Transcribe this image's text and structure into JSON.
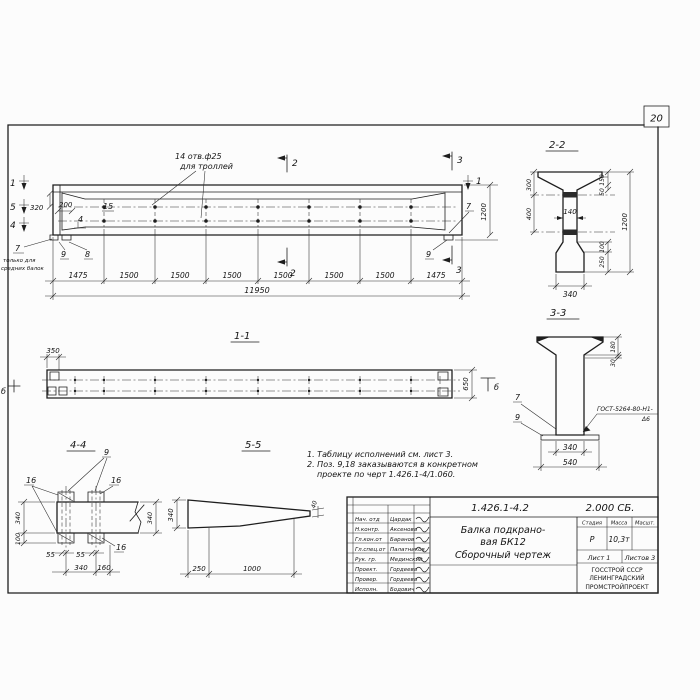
{
  "sheet": {
    "number": "20"
  },
  "main_view": {
    "holes_note1": "14 отв.ф25",
    "holes_note2": "для троллей",
    "mark_1_left": "1",
    "mark_5": "5",
    "mark_4": "4",
    "mark_2_top": "2",
    "mark_2_bottom": "2",
    "mark_3_top": "3",
    "mark_3_bottom": "3",
    "mark_1_right": "1",
    "dim_320": "320",
    "dim_200": "200",
    "pos_15": "15",
    "pos_4": "4",
    "pos_7": "7",
    "note_7a": "только для",
    "note_7b": "средних балок",
    "pos_9_left": "9",
    "pos_8": "8",
    "pos_9_right": "9",
    "pos_7_right": "7",
    "dim_1200": "1200",
    "segs": [
      "1475",
      "1500",
      "1500",
      "1500",
      "1500",
      "1500",
      "1500",
      "1475"
    ],
    "total": "11950"
  },
  "section_2_2": {
    "title": "2-2",
    "d300": "300",
    "d400": "400",
    "d150": "150",
    "d50": "50",
    "d1200": "1200",
    "d100": "100",
    "d250": "250",
    "d140": "140",
    "d340": "340"
  },
  "section_3_3": {
    "title": "3-3",
    "d180": "180",
    "d30": "30",
    "d340": "340",
    "d540": "540",
    "pos7": "7",
    "pos9": "9",
    "weld1": "ГОСТ-5264-80-Н1-",
    "weld2": "Δ6"
  },
  "section_1_1": {
    "title": "1-1",
    "d350": "350",
    "d650": "650",
    "mark_left": "б",
    "mark_right": "б"
  },
  "section_4_4": {
    "title": "4-4",
    "pos9": "9",
    "pos16_left": "16",
    "pos16_right": "16",
    "pos16_bottom": "16",
    "d340_left": "340",
    "d100": "100",
    "d340_right": "340",
    "d55a": "55",
    "d55b": "55",
    "d340_bottom": "340",
    "d160": "160"
  },
  "section_5_5": {
    "title": "5-5",
    "d340": "340",
    "d250": "250",
    "d1000": "1000",
    "d40": "40"
  },
  "notes": {
    "n1": "1. Таблицу исполнений см. лист 3.",
    "n2": "2. Поз. 9,18 заказываются в конкретном",
    "n3": "проекте по черт 1.426.1-4/1.060."
  },
  "title_block": {
    "doc_number": "1.426.1-4.2",
    "doc_suffix": "2.000 СБ.",
    "title_line1": "Балка подкрано-",
    "title_line2": "вая БК12",
    "title_line3": "Сборочный чертеж",
    "col_stage": "Стадия",
    "col_mass": "Масса",
    "col_scale": "Масшт.",
    "stage": "Р",
    "mass": "10,3т",
    "sheet_label": "Лист 1",
    "sheets_label": "Листов 3",
    "org_line1": "ГОССТРОЙ СССР",
    "org_line2": "ЛЕНИНГРАДСКИЙ",
    "org_line3": "ПРОМСТРОЙПРОЕКТ",
    "roles": [
      {
        "role": "Нач. отд",
        "name": "Цардак"
      },
      {
        "role": "Н.контр.",
        "name": "Аксенова"
      },
      {
        "role": "Гл.кон.от",
        "name": "Баранов"
      },
      {
        "role": "Гл.спец.от",
        "name": "Палатников"
      },
      {
        "role": "Рук. гр.",
        "name": "Мединский"
      },
      {
        "role": "Проект.",
        "name": "Гордеева"
      },
      {
        "role": "Провер.",
        "name": "Гордеева"
      },
      {
        "role": "Исполн.",
        "name": "Бодович"
      }
    ]
  }
}
